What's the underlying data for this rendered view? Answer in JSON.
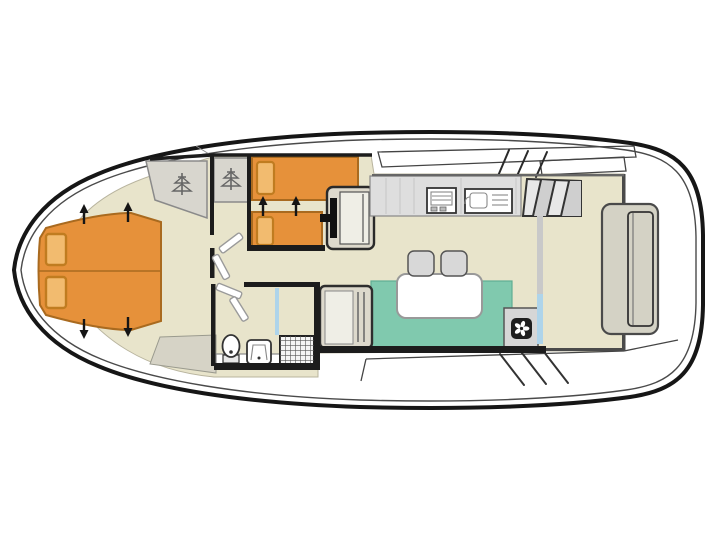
{
  "title": "Houseboat deck plan (top view)",
  "diagram_type": "boat-floorplan",
  "orientation": {
    "bow": "left",
    "stern": "right"
  },
  "rooms": [
    {
      "id": "bow-cabin",
      "label": "bow cabin with double bed"
    },
    {
      "id": "mid-cabin",
      "label": "mid cabin with twin single beds"
    },
    {
      "id": "bathroom",
      "label": "bathroom with toilet, washbasin, shower"
    },
    {
      "id": "galley",
      "label": "galley with hob and sink"
    },
    {
      "id": "saloon",
      "label": "saloon with dinette sofa, table and stools"
    },
    {
      "id": "helm",
      "label": "inside steering position with seat"
    },
    {
      "id": "aft-deck",
      "label": "aft deck with stern bench"
    }
  ],
  "furniture": [
    "double-bed",
    "pillow",
    "pillow",
    "wardrobe",
    "wardrobe",
    "single-bed",
    "single-bed",
    "pillow",
    "pillow",
    "helm-seat",
    "steering-column",
    "galley-counter",
    "hob",
    "sink",
    "companionway-steps",
    "dinette-sofa",
    "dinette-table",
    "stool",
    "stool",
    "bench-seat",
    "fan-heater-unit",
    "toilet",
    "washbasin",
    "shower-tray",
    "shower-screen",
    "sliding-door",
    "stern-bench",
    "floor-mat"
  ],
  "colors": {
    "background": "#ffffff",
    "hull_line": "#161616",
    "hull_inner_line": "#4a4a4a",
    "deck": "#ffffff",
    "floor": "#e8e4cb",
    "floor_edge": "#b8b49e",
    "wall": "#1c1c1c",
    "wall_light": "#4a4a4a",
    "bed": "#e6913a",
    "bed_edge": "#a96a1f",
    "pillow": "#f2bb6f",
    "pillow_edge": "#c07c20",
    "wardrobe": "#d8d6ce",
    "wardrobe_edge": "#8a8a8a",
    "hanger": "#666666",
    "sofa": "#80c9ae",
    "sofa_edge": "#5fae93",
    "table": "#ffffff",
    "stool": "#d8d8d8",
    "counter": "#dedede",
    "seat": "#ddd9cc",
    "seat_pad": "#efeee6",
    "bench": "#d4d2c5",
    "steps": "#e8e8e8",
    "step_shade": "#cfcfcf",
    "screen_blue": "#aed4ea",
    "partition_gray": "#c9c9c9",
    "mat": "#d6d3c6",
    "fan_box": "#d6d6d6",
    "fan_dark": "#1e1e1e",
    "shower_base": "#f5f5f5"
  }
}
